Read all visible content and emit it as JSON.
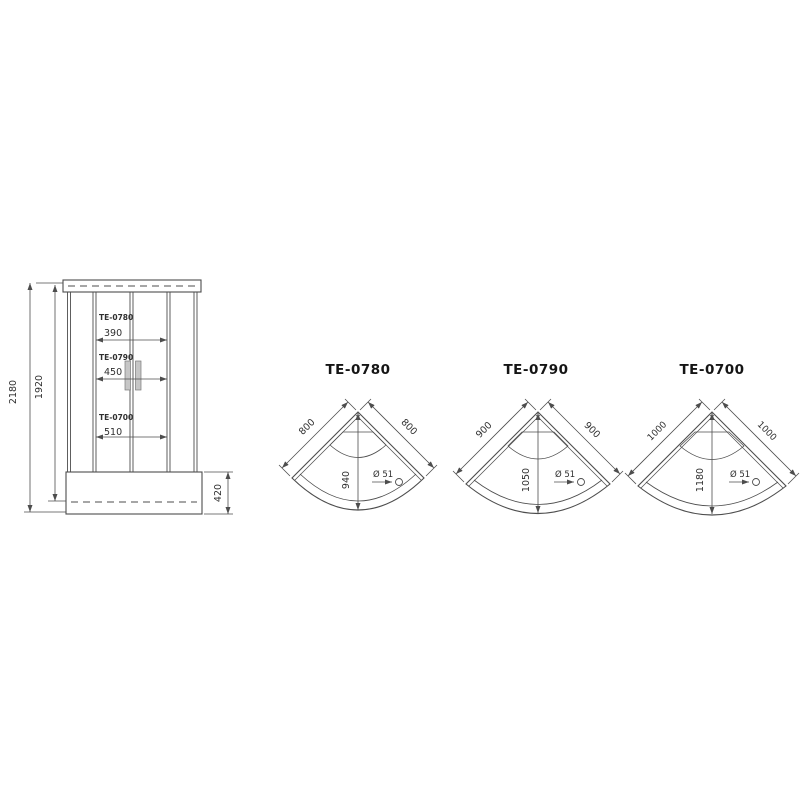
{
  "page": {
    "background": "#ffffff",
    "line_color": "#4d4d4d",
    "text_color": "#2f2f2f",
    "description": "Technical dimension drawing of corner shower cabins: one front elevation and three top-view tray plans"
  },
  "front_view": {
    "overall_height": "2180",
    "cabin_height": "1920",
    "tray_height": "420",
    "door_openings": [
      {
        "model": "TE-0780",
        "width": "390"
      },
      {
        "model": "TE-0790",
        "width": "450"
      },
      {
        "model": "TE-0700",
        "width": "510"
      }
    ]
  },
  "top_views": [
    {
      "model": "TE-0780",
      "side_left": "800",
      "side_right": "800",
      "depth": "940",
      "drain_diameter": "Ø 51"
    },
    {
      "model": "TE-0790",
      "side_left": "900",
      "side_right": "900",
      "depth": "1050",
      "drain_diameter": "Ø 51"
    },
    {
      "model": "TE-0700",
      "side_left": "1000",
      "side_right": "1000",
      "depth": "1180",
      "drain_diameter": "Ø 51"
    }
  ]
}
